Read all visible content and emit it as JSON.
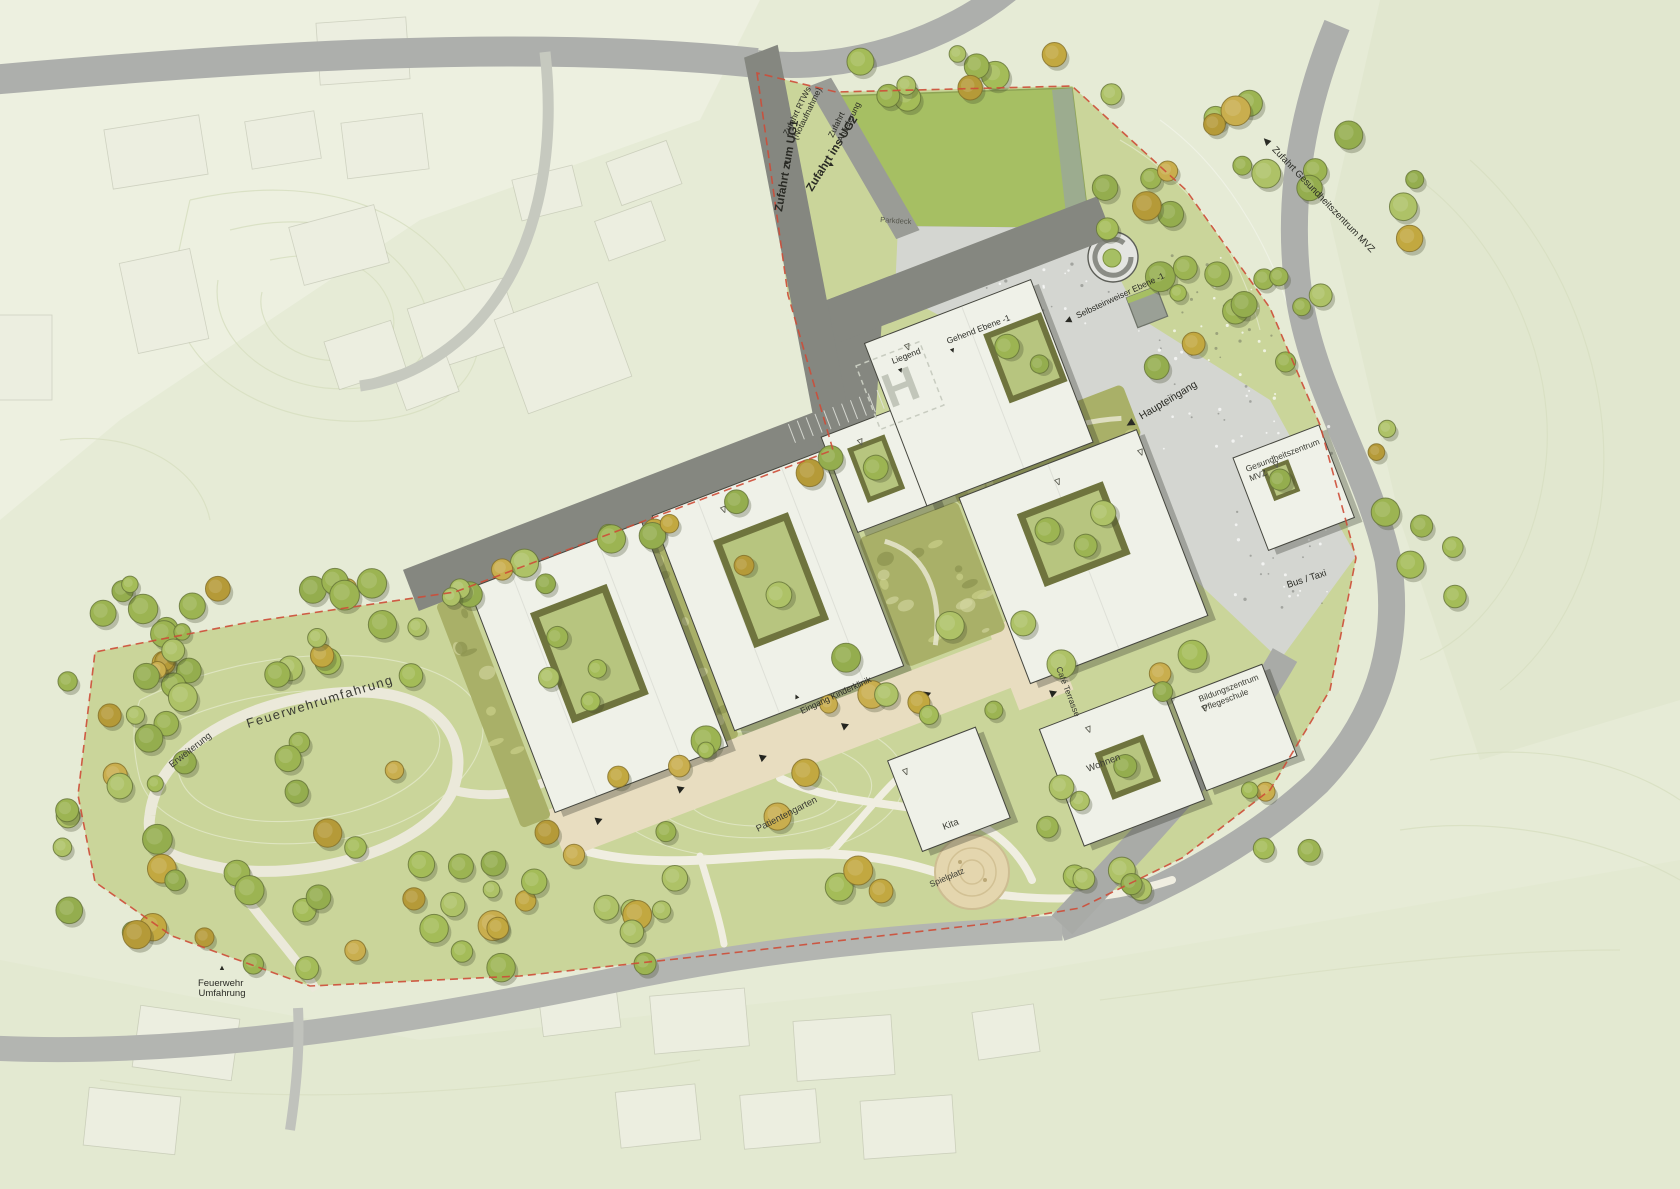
{
  "plan": {
    "type": "Lageplan Klinikcampus",
    "labels": {
      "zufahrt_rtws_line1": "Zufahrt RTWs",
      "zufahrt_rtws_line2": "(Notaufnahme)",
      "zufahrt_anlieferung_line1": "Zufahrt",
      "zufahrt_anlieferung_line2": "Anlieferung",
      "zufahrt_ug1": "Zufahrt zum UG1",
      "zufahrt_ug2": "Zufahrt ins UG2",
      "parkdeck": "Parkdeck",
      "selbsteinweiser": "Selbsteinweiser Ebene -1",
      "liegend": "Liegend",
      "gehend": "Gehend Ebene -1",
      "helipad": "H",
      "haupteingang": "Haupteingang",
      "zufahrt_mvz": "Zufahrt Gesundheitszentrum MVZ",
      "gesundheitszentrum_line1": "Gesundheitszentrum",
      "gesundheitszentrum_line2": "MVZ",
      "bus_taxi": "Bus / Taxi",
      "cafe_terrasse": "Café Terrasse",
      "eingang_kinderklinik": "Eingang Kinderklinik",
      "patientengarten": "Patientengarten",
      "spielplatz": "Spielplatz",
      "kita": "Kita",
      "wohnen": "Wohnen",
      "bildungszentrum_line1": "Bildungszentrum",
      "bildungszentrum_line2": "Pflegeschule",
      "feuerwehrumfahrung": "Feuerwehrumfahrung",
      "erweiterung": "Erweiterung",
      "feuerwehr_line1": "Feuerwehr",
      "feuerwehr_line2": "Umfahrung"
    },
    "icons": {
      "arrow_left": "◀",
      "arrow_up": "▲",
      "arrow_down": "▼",
      "level_marker": "∇"
    },
    "colors": {
      "site_lawn": "#cad59a",
      "outer_field": "#e6ebd6",
      "parkdeck_green": "#a6bf63",
      "road_gray": "#adafac",
      "access_road_dark": "#858780",
      "plaza_gray": "#d4d6d1",
      "building_fill": "#eff1e8",
      "terrace_beige": "#e8ddc0",
      "boundary_red": "#cd4c37",
      "tree_green": "#a4bc58",
      "tree_olive": "#c2a840",
      "sand": "#e4d6ae"
    }
  }
}
